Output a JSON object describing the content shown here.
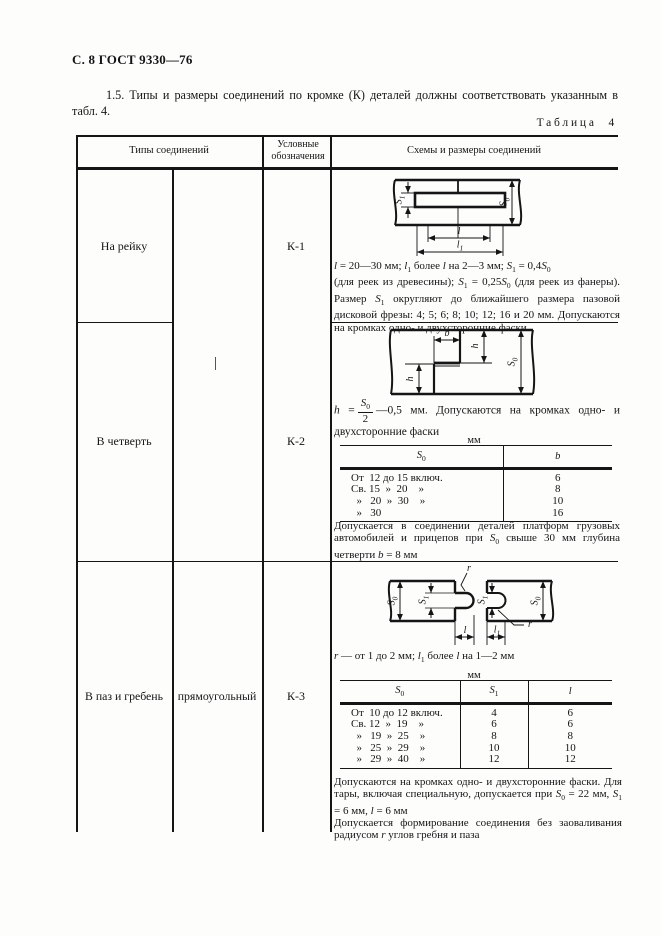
{
  "page": {
    "header": "С. 8 ГОСТ 9330—76",
    "intro": "1.5. Типы и размеры соединений по кромке (К) деталей должны соответствовать указанным в табл. 4.",
    "table_label": "Таблица 4"
  },
  "sym": {
    "s0": "<i>S</i><sub>0</sub>",
    "s1": "<i>S</i><sub>1</sub>",
    "l": "<i>l</i>",
    "l1": "<i>l</i><sub>1</sub>",
    "b": "<i>b</i>",
    "h": "<i>h</i>",
    "r": "<i>r</i>"
  },
  "table": {
    "col_types": "Типы соединений",
    "col_code": "Условные обозначения",
    "col_scheme": "Схемы и размеры соединений",
    "rows": [
      {
        "type": "На рейку",
        "code": "К-1",
        "note": "<i>l</i> = 20—30 мм; <i>l</i><sub>1</sub> более <i>l</i> на 2—3 мм; <i>S</i><sub>1</sub> = 0,4<i>S</i><sub>0</sub><br>(для реек из древесины); <i>S</i><sub>1</sub> = 0,25<i>S</i><sub>0</sub> (для реек из фанеры). Размер <i>S</i><sub>1</sub> округляют до ближайшего размера пазовой дисковой фрезы: 4; 5; 6; 8; 10; 12; 16 и 20 мм. Допускаются на кромках одно- и двухсторонние фаски"
      },
      {
        "type": "В четверть",
        "code": "К-2",
        "formula_lhs": "<i>h</i> =",
        "formula_num": "<i>S</i><sub>0</sub>",
        "formula_den": "2",
        "formula_rhs": "—0,5 мм. Допускаются на кромках одно- и двухсторонние фаски",
        "unit": "мм",
        "sub": {
          "h1": "<i>S</i><sub>0</sub>",
          "h2": "<i>b</i>",
          "rows": [
            [
              "От  12 до 15 включ.",
              "6"
            ],
            [
              "Св. 15  »  20    »",
              "8"
            ],
            [
              "  »   20  »  30    »",
              "10"
            ],
            [
              "  »   30",
              "16"
            ]
          ]
        },
        "note": "Допускается в соединении деталей платформ грузовых автомобилей и прицепов при <i>S</i><sub>0</sub> свыше 30 мм глубина четверти <i>b</i> = 8 мм"
      },
      {
        "type": "В паз и гребень",
        "subtype": "прямоугольный",
        "code": "К-3",
        "note1": "<i>r</i> — от 1 до 2 мм; <i>l</i><sub>1</sub> более <i>l</i> на 1—2 мм",
        "unit": "мм",
        "sub": {
          "h1": "<i>S</i><sub>0</sub>",
          "h2": "<i>S</i><sub>1</sub>",
          "h3": "<i>l</i>",
          "rows": [
            [
              "От  10 до 12 включ.",
              "4",
              "6"
            ],
            [
              "Св. 12  »  19    »",
              "6",
              "6"
            ],
            [
              "  »   19  »  25    »",
              "8",
              "8"
            ],
            [
              "  »   25  »  29    »",
              "10",
              "10"
            ],
            [
              "  »   29  »  40    »",
              "12",
              "12"
            ]
          ]
        },
        "note2": "Допускаются на кромках одно- и двухсторонние фаски. Для тары, включая специальную, допускается при <i>S</i><sub>0</sub> = 22 мм, <i>S</i><sub>1</sub> = 6 мм, <i>l</i> = 6 мм<br>Допускается формирование соединения без заоваливания радиусом <i>r</i> углов гребня и паза"
      }
    ]
  }
}
